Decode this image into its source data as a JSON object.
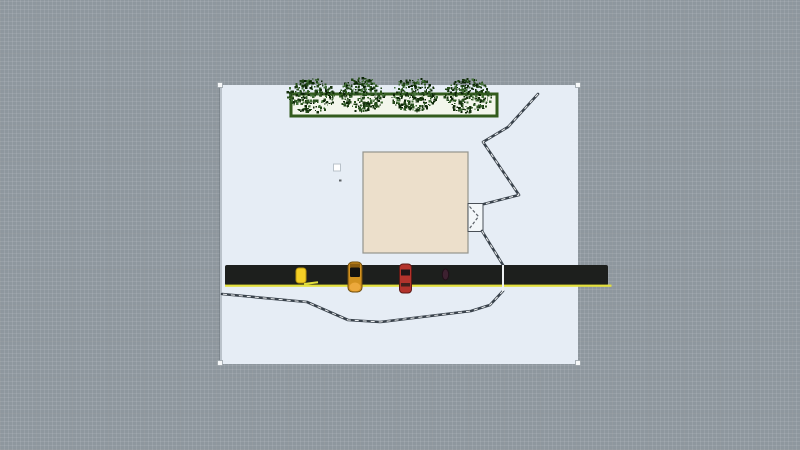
{
  "viewport": {
    "width": 800,
    "height": 450
  },
  "colors": {
    "workspace_grid": "#8e979e",
    "canvas_sheet": "#e6edf5",
    "planter_fill": "#f3f6ec",
    "planter_border": "#335c1d",
    "tree_greens": [
      "#14300c",
      "#224618",
      "#0c2407",
      "#2c5520",
      "#44703a"
    ],
    "building_fill": "#ecdfcb",
    "building_border": "#94948c",
    "fence": "#39424b",
    "fence_dash": "#f2f4f5",
    "road": "#1d1f1d",
    "lane_line": "#e4e03c",
    "vehicle_yellow": "#f4cf25",
    "vehicle_taxi": "#d3921f",
    "vehicle_red": "#b3332c",
    "handle_fill": "#f6f8f9"
  },
  "scene": {
    "objects": [
      {
        "type": "rect",
        "name": "canvas-sheet",
        "interactable": true,
        "x": 220,
        "y": 85,
        "w": 358,
        "h": 279,
        "fill": "#e6edf5"
      },
      {
        "type": "rect",
        "name": "canvas-left-shade",
        "interactable": false,
        "x": 219,
        "y": 85,
        "w": 3,
        "h": 279,
        "fill": "rgba(85,95,104,0.30)"
      },
      {
        "type": "rect",
        "name": "planter",
        "interactable": true,
        "x": 291,
        "y": 94,
        "w": 206,
        "h": 22,
        "fill": "#f3f6ec",
        "stroke": "#335c1d",
        "sw": 3
      },
      {
        "type": "scatter",
        "name": "tree-1",
        "interactable": true,
        "cx": 311,
        "cy": 96,
        "rx": 24,
        "ry": 17,
        "count": 260,
        "seed": 7,
        "sizes": [
          1,
          2.6
        ],
        "colors": [
          "#14300c",
          "#224618",
          "#0c2407",
          "#2c5520",
          "#44703a"
        ]
      },
      {
        "type": "scatter",
        "name": "tree-2",
        "interactable": true,
        "cx": 362,
        "cy": 95,
        "rx": 23,
        "ry": 17,
        "count": 260,
        "seed": 21,
        "sizes": [
          1,
          2.6
        ],
        "colors": [
          "#14300c",
          "#224618",
          "#0c2407",
          "#2c5520",
          "#44703a"
        ]
      },
      {
        "type": "scatter",
        "name": "tree-3",
        "interactable": true,
        "cx": 414,
        "cy": 95,
        "rx": 23,
        "ry": 17,
        "count": 260,
        "seed": 35,
        "sizes": [
          1,
          2.6
        ],
        "colors": [
          "#14300c",
          "#224618",
          "#0c2407",
          "#2c5520",
          "#44703a"
        ]
      },
      {
        "type": "scatter",
        "name": "tree-4",
        "interactable": true,
        "cx": 468,
        "cy": 96,
        "rx": 24,
        "ry": 17,
        "count": 260,
        "seed": 49,
        "sizes": [
          1,
          2.6
        ],
        "colors": [
          "#14300c",
          "#224618",
          "#0c2407",
          "#2c5520",
          "#44703a"
        ]
      },
      {
        "type": "rect",
        "name": "building",
        "interactable": true,
        "x": 363,
        "y": 152,
        "w": 105,
        "h": 101,
        "fill": "#ecdfcb",
        "stroke": "#94948c",
        "sw": 1.2
      },
      {
        "type": "rect",
        "name": "gate-box",
        "interactable": true,
        "x": 468,
        "y": 203.5,
        "w": 15,
        "h": 28,
        "fill": "#f3f7f9",
        "stroke": "#4a5057",
        "sw": 1
      },
      {
        "type": "polyline",
        "name": "gate-swing-symbol",
        "interactable": false,
        "points": "469.5,206.5 478.5,216.5 469.5,228.5",
        "stroke": "#5a6067",
        "sw": 1.2,
        "dash": "3 2"
      },
      {
        "type": "fence",
        "name": "fence-upper",
        "interactable": true,
        "points": "538,94 508,127 483,142 519,195 484,204"
      },
      {
        "type": "fence",
        "name": "fence-gate-to-road",
        "interactable": true,
        "points": "482,231 503,265"
      },
      {
        "type": "fence",
        "name": "fence-lower",
        "interactable": true,
        "points": "503,291 490,305 471,311 380,322 348,320 307,302 222,294"
      },
      {
        "type": "rect",
        "name": "road",
        "interactable": true,
        "x": 225,
        "y": 265,
        "w": 383,
        "h": 20.5,
        "rx": 2,
        "fill": "#1d1f1d"
      },
      {
        "type": "rect",
        "name": "road-lane-line",
        "interactable": false,
        "x": 225,
        "y": 284.6,
        "w": 386.5,
        "h": 2.2,
        "fill": "#e4e03c"
      },
      {
        "type": "line",
        "name": "lane-dash",
        "interactable": false,
        "pts": [
          304,
          284,
          318,
          282.2
        ],
        "stroke": "#e4e03c",
        "sw": 2
      },
      {
        "type": "line",
        "name": "fence-road-crossing",
        "interactable": false,
        "pts": [
          503,
          265,
          503,
          291
        ],
        "stroke": "#eef1f2",
        "sw": 2
      },
      {
        "type": "rect",
        "name": "vehicle-yellow-cart",
        "interactable": true,
        "x": 296,
        "y": 268,
        "w": 10,
        "h": 15,
        "rx": 3,
        "fill": "#f4cf25",
        "stroke": "#b8950e",
        "sw": 1
      },
      {
        "type": "rect",
        "name": "vehicle-taxi-body",
        "interactable": true,
        "x": 348,
        "y": 262,
        "w": 14,
        "h": 30,
        "rx": 4.5,
        "fill": "#d3921f",
        "stroke": "#6e4c0d",
        "sw": 1
      },
      {
        "type": "rect",
        "name": "vehicle-taxi-hood",
        "interactable": false,
        "x": 350,
        "y": 263.5,
        "w": 10,
        "h": 4,
        "fill": "#8a5c10"
      },
      {
        "type": "rect",
        "name": "vehicle-taxi-window",
        "interactable": false,
        "x": 350,
        "y": 267.5,
        "w": 10,
        "h": 9.5,
        "rx": 1,
        "fill": "#131210"
      },
      {
        "type": "ellipse",
        "name": "vehicle-taxi-tail",
        "interactable": false,
        "cx": 355,
        "cy": 287,
        "rx": 5.5,
        "ry": 4.5,
        "fill": "#eda93c"
      },
      {
        "type": "rect",
        "name": "vehicle-red-body",
        "interactable": true,
        "x": 399.5,
        "y": 264,
        "w": 12,
        "h": 29,
        "rx": 3.5,
        "fill": "#b3332c",
        "stroke": "#5e1a16",
        "sw": 1
      },
      {
        "type": "rect",
        "name": "vehicle-red-windshield",
        "interactable": false,
        "x": 401,
        "y": 269.5,
        "w": 9,
        "h": 6,
        "fill": "#1f1517"
      },
      {
        "type": "rect",
        "name": "vehicle-red-rear-window",
        "interactable": false,
        "x": 401,
        "y": 283,
        "w": 9,
        "h": 3.5,
        "fill": "#43201d"
      },
      {
        "type": "ellipse",
        "name": "pedestrian",
        "interactable": true,
        "cx": 445.5,
        "cy": 274.5,
        "rx": 3.2,
        "ry": 5.5,
        "fill": "#3d2130",
        "stroke": "#201018",
        "sw": 1
      },
      {
        "type": "rect",
        "name": "waypoint-marker",
        "interactable": true,
        "x": 333.5,
        "y": 164,
        "w": 7,
        "h": 7,
        "fill": "#ffffff",
        "stroke": "#b9c2ca",
        "sw": 1
      },
      {
        "type": "rect",
        "name": "marker-speck",
        "interactable": false,
        "x": 339,
        "y": 179.5,
        "w": 2.5,
        "h": 2,
        "fill": "#5d6266"
      },
      {
        "type": "rect",
        "name": "resize-handle-nw",
        "interactable": true,
        "x": 217.5,
        "y": 82.5,
        "w": 5,
        "h": 5,
        "fill": "#f6f8f9",
        "stroke": "#9aa2a8",
        "sw": 0.8
      },
      {
        "type": "rect",
        "name": "resize-handle-ne",
        "interactable": true,
        "x": 575.5,
        "y": 82.5,
        "w": 5,
        "h": 5,
        "fill": "#f6f8f9",
        "stroke": "#9aa2a8",
        "sw": 0.8
      },
      {
        "type": "rect",
        "name": "resize-handle-sw",
        "interactable": true,
        "x": 217.5,
        "y": 360.5,
        "w": 5,
        "h": 5,
        "fill": "#f6f8f9",
        "stroke": "#9aa2a8",
        "sw": 0.8
      },
      {
        "type": "rect",
        "name": "resize-handle-se",
        "interactable": true,
        "x": 575.5,
        "y": 360.5,
        "w": 5,
        "h": 5,
        "fill": "#f6f8f9",
        "stroke": "#9aa2a8",
        "sw": 0.8
      }
    ]
  }
}
